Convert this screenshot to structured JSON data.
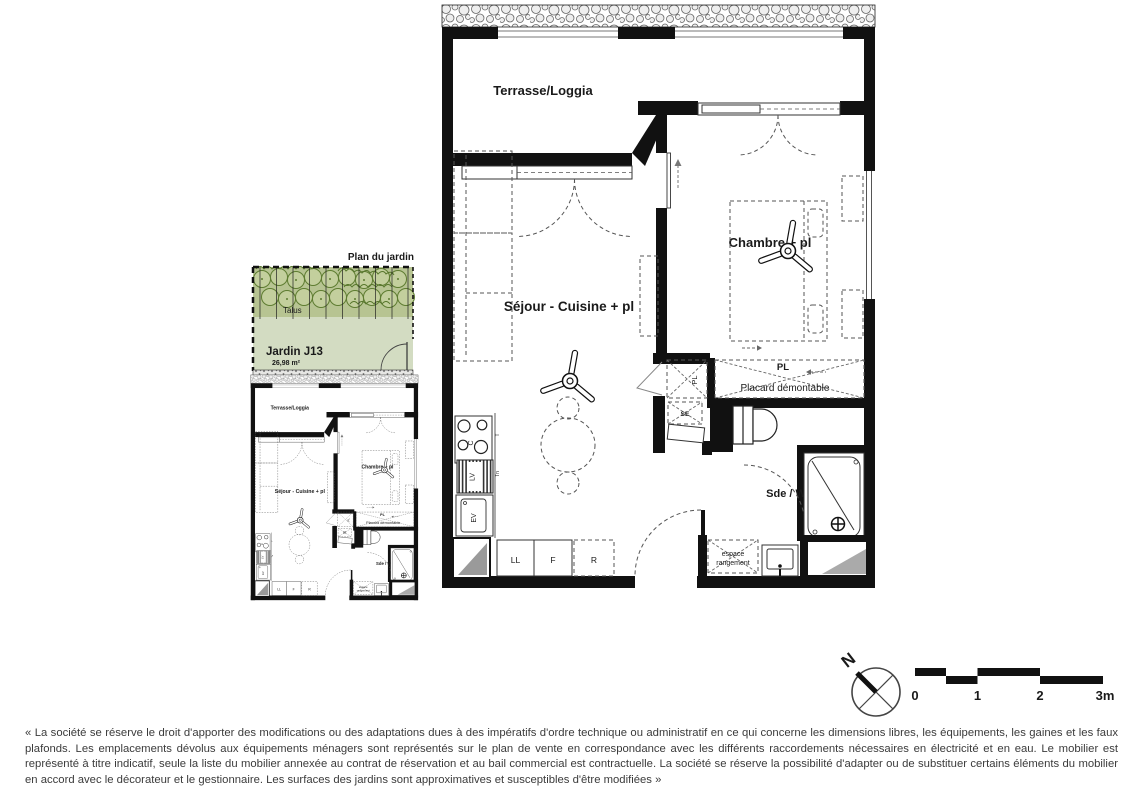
{
  "colors": {
    "grass": "#d3dcc2",
    "talus_band": "#b7c492",
    "tree_green": "#5e7c31",
    "wall_black": "#111111"
  },
  "garden_plan": {
    "title": "Plan du jardin",
    "talus_label": "Talus",
    "garden_name": "Jardin J13",
    "garden_area": "26,98 m²"
  },
  "floor_plan": {
    "terrace_label": "Terrasse/Loggia",
    "living_label": "Séjour - Cuisine + pl",
    "bedroom_label": "Chambre + pl",
    "bathroom_label": "Sde / WC",
    "closet_tag": "PL",
    "closet_tag_vertical": "PL",
    "placard_label": "Placard démontable",
    "storage_line1": "espace",
    "storage_line2": "rangement",
    "tech_box_label": "SE",
    "kitchen": {
      "cooktop": "C",
      "dishwasher": "LV",
      "sink": "EV",
      "washing_machine": "LL",
      "fridge": "F",
      "reserve": "R",
      "tag_top": "T",
      "tag_bottom": "Tn"
    }
  },
  "compass": {
    "north": "N"
  },
  "scale_bar": {
    "tick0": "0",
    "tick1": "1",
    "tick2": "2",
    "tick3": "3m"
  },
  "footer": {
    "disclaimer": "« La société se réserve le droit d'apporter des modifications ou des adaptations dues à des impératifs d'ordre technique ou administratif en ce qui concerne les dimensions libres, les équipements, les gaines et les faux plafonds. Les emplacements dévolus aux équipements ménagers sont représentés sur le plan de vente en correspondance avec les différents raccordements nécessaires en électricité et en eau. Le mobilier est représenté à titre indicatif, seule la liste du mobilier annexée au contrat de réservation et au bail commercial est contractuelle. La société se réserve la possibilité d'adapter ou de substituer certains éléments du mobilier en accord avec le décorateur et le gestionnaire. Les surfaces des jardins sont approximatives et susceptibles d'être modifiées »"
  }
}
